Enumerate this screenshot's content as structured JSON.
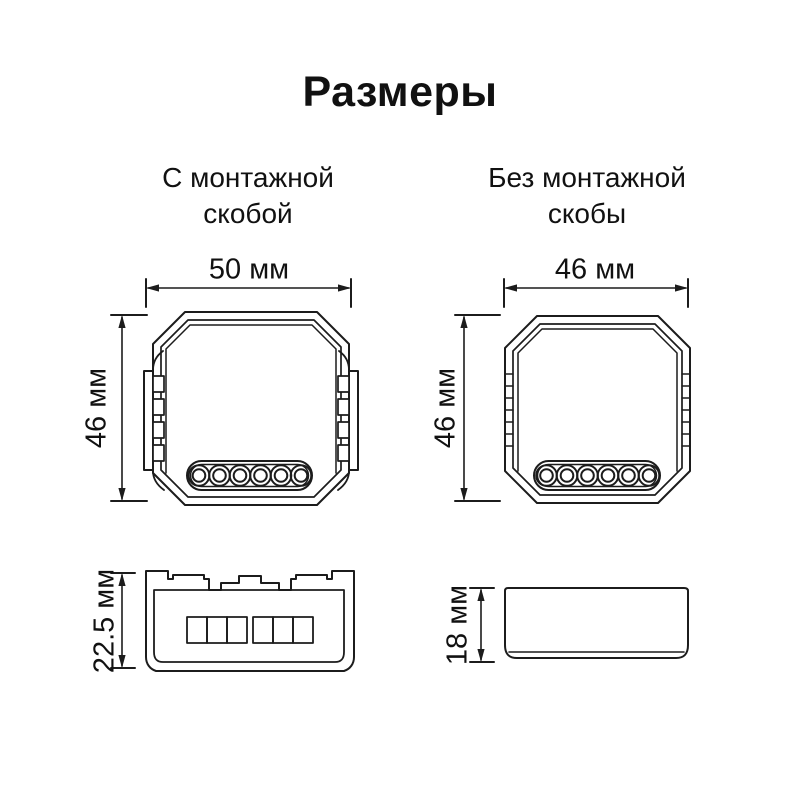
{
  "title": "Размеры",
  "views": {
    "with_bracket": {
      "heading_line1": "С монтажной",
      "heading_line2": "скобой",
      "width": "50 мм",
      "height": "46 мм",
      "depth": "22.5 мм"
    },
    "without_bracket": {
      "heading_line1": "Без монтажной",
      "heading_line2": "скобы",
      "width": "46 мм",
      "height": "46 мм",
      "depth": "18 мм"
    }
  },
  "colors": {
    "line": "#1c1c1c",
    "text": "#111111",
    "background": "#ffffff"
  }
}
